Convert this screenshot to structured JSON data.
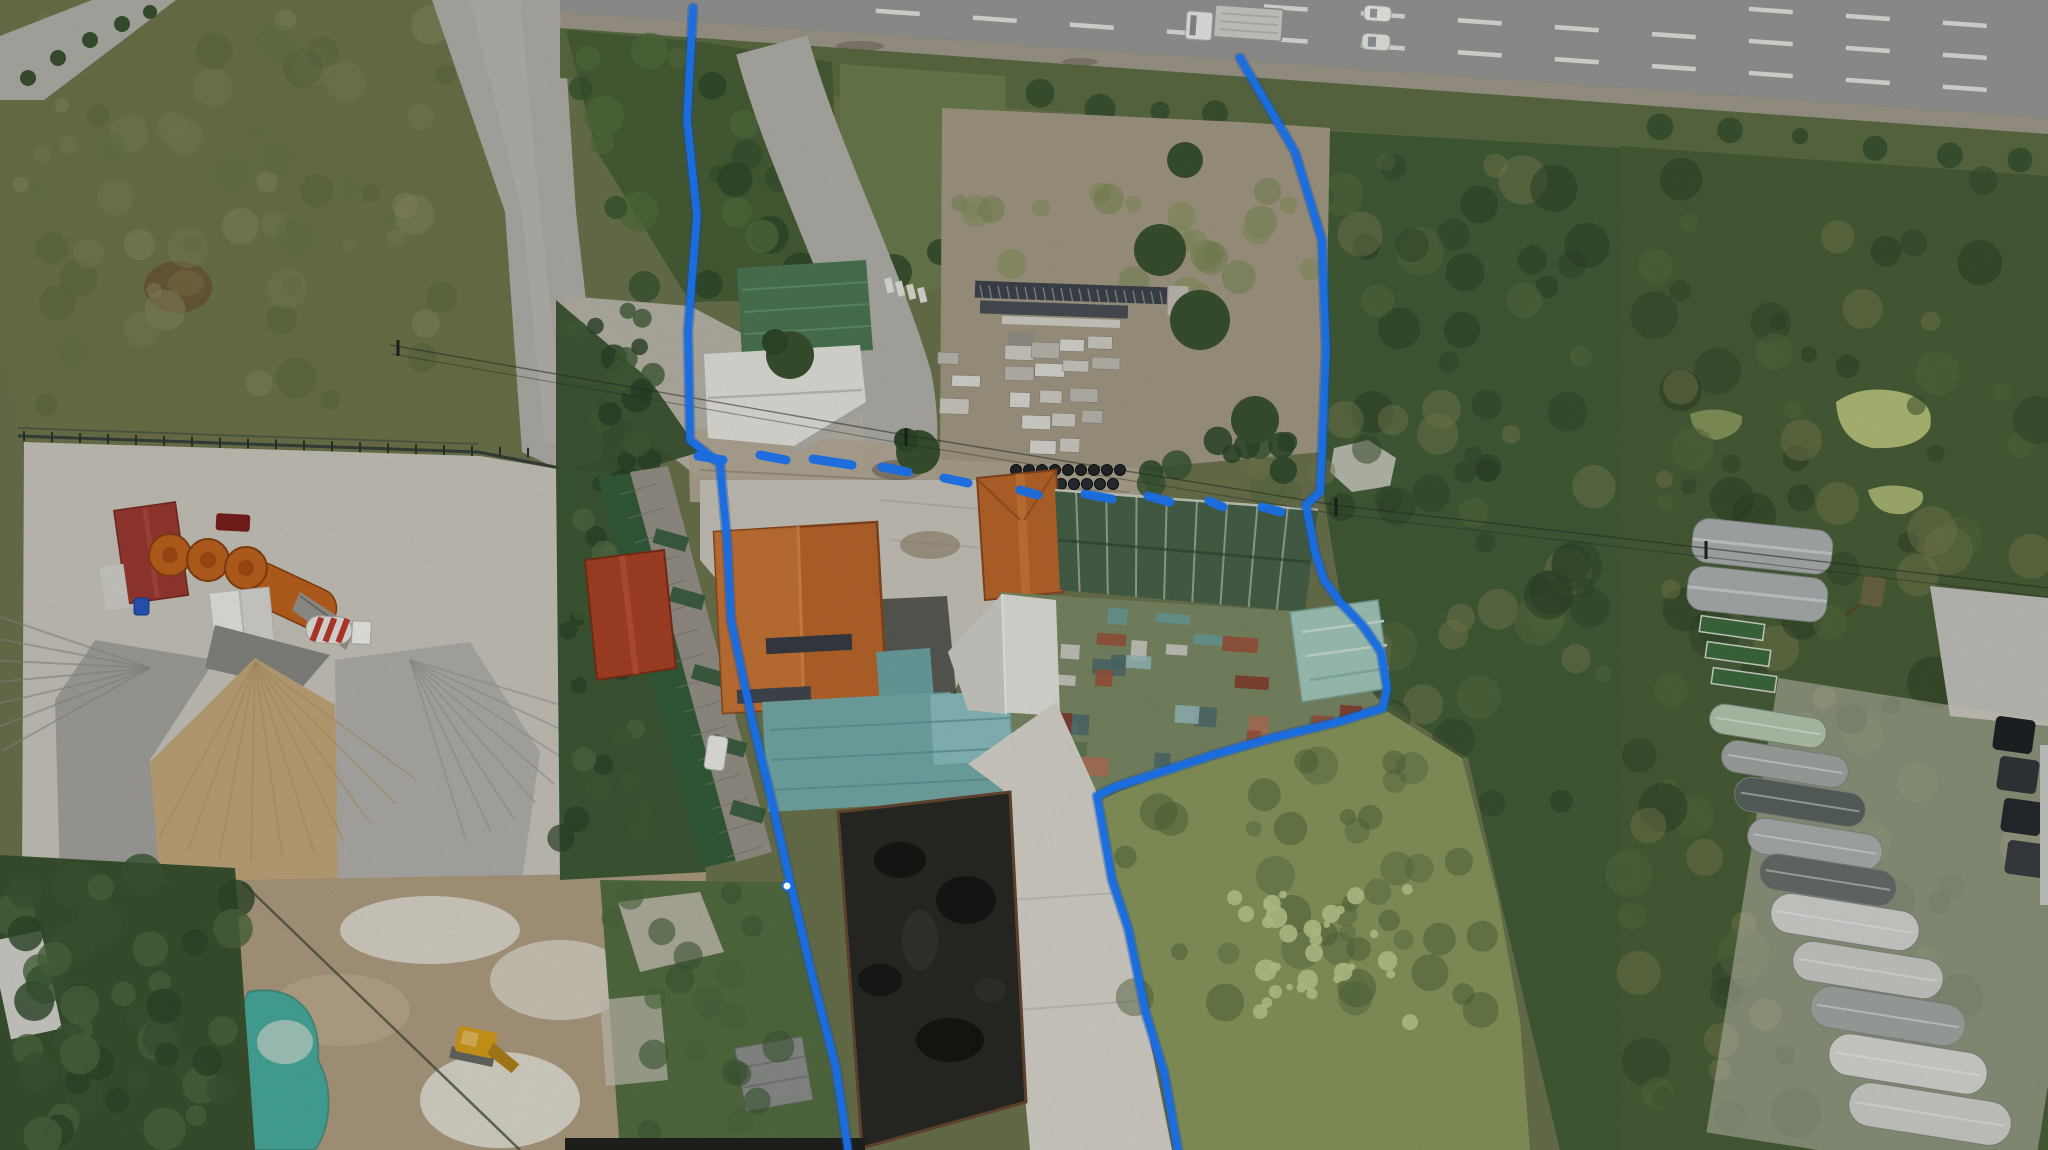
{
  "meta": {
    "type": "aerial-drone-photograph",
    "description": "Aerial drone photo of a roadside property outlined with a hand-drawn blue boundary line, between a concrete batching plant on the left and wetland scrub with greenhouse rows on the right, fronted by a multi-lane highway at the top.",
    "width": 2048,
    "height": 1150
  },
  "palette": {
    "boundary_blue": "#1a6ce0",
    "highway_asphalt": "#9b9b99",
    "shoulder_gravel": "#a7a093",
    "concrete_road": "#b6b4ad",
    "plant_concrete": "#cfcbc2",
    "junction_concrete": "#bdb9ae",
    "verge_grass": "#5f7046",
    "island_green": "#4a6238",
    "lawn_green": "#6f8150",
    "scrub_dark": "#46603a",
    "field_scrub": "#70794d",
    "grass_field": "#8d9c60",
    "duckweed_light": "#c2cf92",
    "tree_dark": "#3c5531",
    "roof_orange": "#c06a2c",
    "roof_orange_light": "#d17d39",
    "roof_red": "#ad4427",
    "roof_brick_red": "#9e3b33",
    "roof_white": "#eceae4",
    "roof_green": "#4e7a55",
    "roof_teal": "#79b0ae",
    "roof_teal_light": "#8fc4c4",
    "roof_mint": "#a8cfc2",
    "roof_patchwork": "#7e8d68",
    "shade_net_green": "#49654a",
    "pit_black": "#2a2a26",
    "sand_tan": "#c7ab7e",
    "gravel_gray": "#a8a7a2",
    "silo_orange": "#c4651f",
    "pond_turquoise": "#4ab0a2",
    "algae_green": "#b8c57c",
    "greenhouse_silver": "#b0b5b4",
    "excavator_yellow": "#d9a21b",
    "apron_white": "#dedbd2",
    "storage_dirt": "#a89f88",
    "rack_steel": "#3f464c",
    "stack_concrete": "#d6d3ca",
    "mud_tan": "#b3a184"
  },
  "boundary": {
    "color": "#1a6ce0",
    "stroke_width": 7.5,
    "style": "solid west/south and east sides, dashed across the road frontage",
    "west_line": [
      [
        693,
        8
      ],
      [
        687,
        120
      ],
      [
        697,
        215
      ],
      [
        688,
        330
      ],
      [
        690,
        440
      ],
      [
        720,
        464
      ],
      [
        727,
        540
      ],
      [
        731,
        620
      ],
      [
        752,
        720
      ],
      [
        772,
        802
      ],
      [
        790,
        882
      ],
      [
        812,
        975
      ],
      [
        836,
        1068
      ],
      [
        848,
        1150
      ]
    ],
    "east_line": [
      [
        1240,
        58
      ],
      [
        1295,
        152
      ],
      [
        1322,
        240
      ],
      [
        1326,
        350
      ],
      [
        1322,
        452
      ],
      [
        1320,
        492
      ],
      [
        1306,
        505
      ],
      [
        1315,
        552
      ],
      [
        1324,
        580
      ],
      [
        1340,
        602
      ],
      [
        1363,
        626
      ],
      [
        1381,
        652
      ],
      [
        1387,
        688
      ],
      [
        1383,
        708
      ],
      [
        1338,
        722
      ],
      [
        1272,
        738
      ],
      [
        1213,
        755
      ],
      [
        1158,
        773
      ],
      [
        1115,
        787
      ],
      [
        1097,
        796
      ],
      [
        1104,
        835
      ],
      [
        1112,
        880
      ],
      [
        1128,
        928
      ],
      [
        1146,
        1014
      ],
      [
        1164,
        1072
      ],
      [
        1178,
        1150
      ]
    ],
    "north_dashes": [
      [
        [
          698,
          456
        ],
        [
          723,
          460
        ]
      ],
      [
        [
          760,
          455
        ],
        [
          786,
          460
        ]
      ],
      [
        [
          813,
          459
        ],
        [
          852,
          465
        ]
      ],
      [
        [
          882,
          467
        ],
        [
          908,
          472
        ]
      ],
      [
        [
          944,
          478
        ],
        [
          968,
          483
        ]
      ],
      [
        [
          1020,
          490
        ],
        [
          1038,
          495
        ]
      ],
      [
        [
          1085,
          494
        ],
        [
          1112,
          499
        ]
      ],
      [
        [
          1148,
          496
        ],
        [
          1170,
          502
        ]
      ],
      [
        [
          1209,
          501
        ],
        [
          1223,
          507
        ]
      ],
      [
        [
          1262,
          507
        ],
        [
          1281,
          512
        ]
      ]
    ],
    "vertex_dot": [
      787,
      886
    ]
  },
  "features": [
    {
      "name": "highway",
      "description": "Multi-lane highway crossing the top edge with white dashed lane lines",
      "bbox": [
        560,
        0,
        1488,
        130
      ]
    },
    {
      "name": "truck-on-highway",
      "description": "White semi truck with long flatbed trailer",
      "bbox": [
        1185,
        4,
        100,
        42
      ]
    },
    {
      "name": "cars-on-highway",
      "description": "Two white cars in the near lanes",
      "bbox": [
        1360,
        4,
        36,
        50
      ]
    },
    {
      "name": "frontage-verge",
      "description": "Grass verge with row of trees between highway and land",
      "bbox": [
        560,
        20,
        1488,
        140
      ]
    },
    {
      "name": "access-road",
      "description": "Concrete access road from highway to the property junction",
      "bbox": [
        740,
        40,
        170,
        440
      ]
    },
    {
      "name": "pedestrian-crossing",
      "description": "Small zebra crossing on the access road",
      "bbox": [
        882,
        276,
        46,
        22
      ]
    },
    {
      "name": "guard-hut",
      "description": "Small teal-roofed hut on the green island",
      "bbox": [
        782,
        94,
        36,
        30
      ]
    },
    {
      "name": "west-concrete-road",
      "description": "Long concrete road running down the left side",
      "bbox": [
        430,
        0,
        210,
        560
      ]
    },
    {
      "name": "northwest-scrub-field",
      "description": "Large overgrown scrub field, top left",
      "bbox": [
        0,
        0,
        520,
        455
      ]
    },
    {
      "name": "cement-plant-yard",
      "description": "Concrete batching plant yard",
      "bbox": [
        20,
        440,
        690,
        440
      ]
    },
    {
      "name": "cement-silos",
      "description": "Three orange cement silos with conveyor",
      "bbox": [
        150,
        535,
        210,
        110
      ]
    },
    {
      "name": "plant-office",
      "description": "Dark red hip-roof office building",
      "bbox": [
        112,
        500,
        80,
        105
      ]
    },
    {
      "name": "mixer-truck",
      "description": "Concrete mixer truck with striped drum",
      "bbox": [
        304,
        614,
        70,
        34
      ]
    },
    {
      "name": "aggregate-piles",
      "description": "Fan of sand and gravel stockpiles",
      "bbox": [
        60,
        620,
        470,
        260
      ]
    },
    {
      "name": "slurry-pond",
      "description": "Turquoise slurry pond, bottom left",
      "bbox": [
        225,
        985,
        110,
        165
      ]
    },
    {
      "name": "excavator",
      "description": "Yellow excavator on muddy ground",
      "bbox": [
        450,
        1022,
        70,
        60
      ]
    },
    {
      "name": "white-warehouse",
      "description": "White-roofed warehouse with green-roof section",
      "bbox": [
        700,
        260,
        175,
        185
      ]
    },
    {
      "name": "orange-roof-house-north",
      "description": "Orange hip-roof building east of the access road",
      "bbox": [
        975,
        468,
        92,
        132
      ]
    },
    {
      "name": "main-orange-roof-house",
      "description": "Large orange hip-roof house in the center",
      "bbox": [
        710,
        518,
        180,
        196
      ]
    },
    {
      "name": "red-roof-house",
      "description": "Smaller red hip-roof house west of the main house",
      "bbox": [
        583,
        548,
        95,
        132
      ]
    },
    {
      "name": "long-warehouse-rows",
      "description": "Long narrow sheds with gray roofs and green shade cloth",
      "bbox": [
        596,
        460,
        192,
        412
      ]
    },
    {
      "name": "teal-metal-roofs",
      "description": "Teal corrugated roofs linking the buildings",
      "bbox": [
        758,
        648,
        260,
        165
      ]
    },
    {
      "name": "shade-net-structure",
      "description": "Dark green shade-net nursery structure",
      "bbox": [
        1050,
        488,
        270,
        125
      ]
    },
    {
      "name": "patchwork-roof",
      "description": "Large weathered roof patched in green, teal, rust and white",
      "bbox": [
        995,
        588,
        392,
        205
      ]
    },
    {
      "name": "mint-roof-building",
      "description": "Pale mint gable-roof building at the east edge of the property",
      "bbox": [
        1285,
        598,
        112,
        102
      ]
    },
    {
      "name": "black-lined-pit",
      "description": "Black-lined rectangular pit / foundation, bottom center",
      "bbox": [
        832,
        790,
        196,
        360
      ]
    },
    {
      "name": "concrete-apron",
      "description": "White concrete apron beside the pit",
      "bbox": [
        1000,
        760,
        175,
        390
      ]
    },
    {
      "name": "materials-storage-yard",
      "description": "Yard with steel racks, concrete block stacks and pipe stacks",
      "bbox": [
        935,
        175,
        395,
        300
      ]
    },
    {
      "name": "southeast-grass-field",
      "description": "Open grassy field inside the south-east boundary",
      "bbox": [
        1100,
        710,
        430,
        440
      ]
    },
    {
      "name": "algae-ponds",
      "description": "Yellow-green algae-covered ponds in the east wetland",
      "bbox": [
        1680,
        385,
        260,
        135
      ]
    },
    {
      "name": "east-wetland-scrub",
      "description": "Dense wetland scrub east of the property",
      "bbox": [
        1320,
        95,
        730,
        1055
      ]
    },
    {
      "name": "silver-greenhouses",
      "description": "Pair of silver quonset greenhouses",
      "bbox": [
        1685,
        520,
        150,
        100
      ]
    },
    {
      "name": "greenhouse-tunnel-rows",
      "description": "Diagonal band of greenhouse tunnels, bottom right",
      "bbox": [
        1700,
        690,
        348,
        460
      ]
    },
    {
      "name": "parked-vehicles",
      "description": "Dark vehicles parked along the right edge",
      "bbox": [
        1988,
        712,
        60,
        180
      ]
    },
    {
      "name": "power-lines",
      "description": "Power lines crossing the site diagonally",
      "bbox": [
        390,
        340,
        1658,
        250
      ]
    },
    {
      "name": "property-boundary",
      "description": "Hand-drawn blue property boundary annotation",
      "bbox": [
        680,
        0,
        710,
        1150
      ]
    }
  ]
}
